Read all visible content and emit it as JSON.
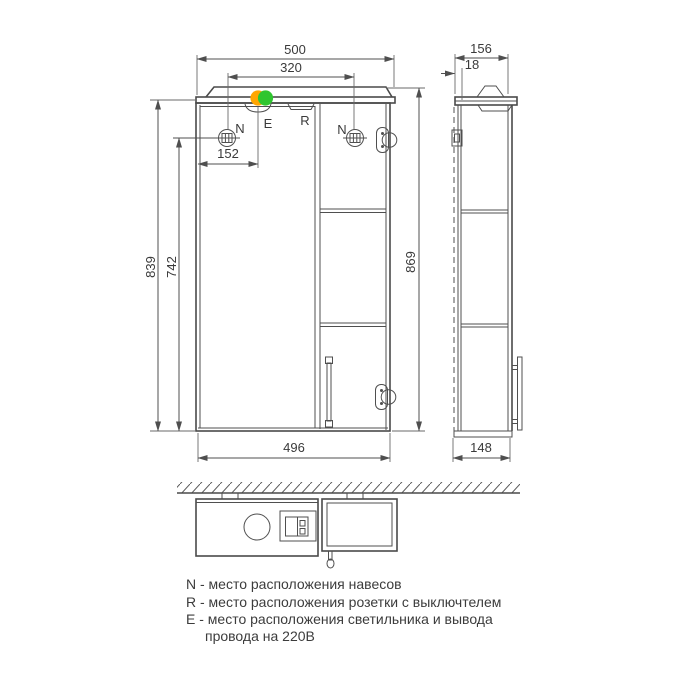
{
  "dimensions": {
    "front_total_width": "500",
    "hanger_spacing": "320",
    "light_offset": "152",
    "mirror_height": "839",
    "hanger_height": "742",
    "total_height": "869",
    "cabinet_width": "496",
    "side_total_depth": "156",
    "door_thickness": "18",
    "side_cabinet_depth": "148"
  },
  "point_labels": {
    "hanger_left": "N",
    "hanger_right": "N",
    "lamp": "E",
    "socket": "R"
  },
  "legend": {
    "line1": "N - место расположения навесов",
    "line2": "R - место расположения розетки с выключтелем",
    "line3": "E - место расположения светильника и вывода",
    "line4": "провода на 220В"
  },
  "colors": {
    "line": "#4f4f4f",
    "text": "#3a3a3a",
    "marker_orange": "#ffa500",
    "marker_green": "#2fc52f",
    "background": "#ffffff"
  }
}
